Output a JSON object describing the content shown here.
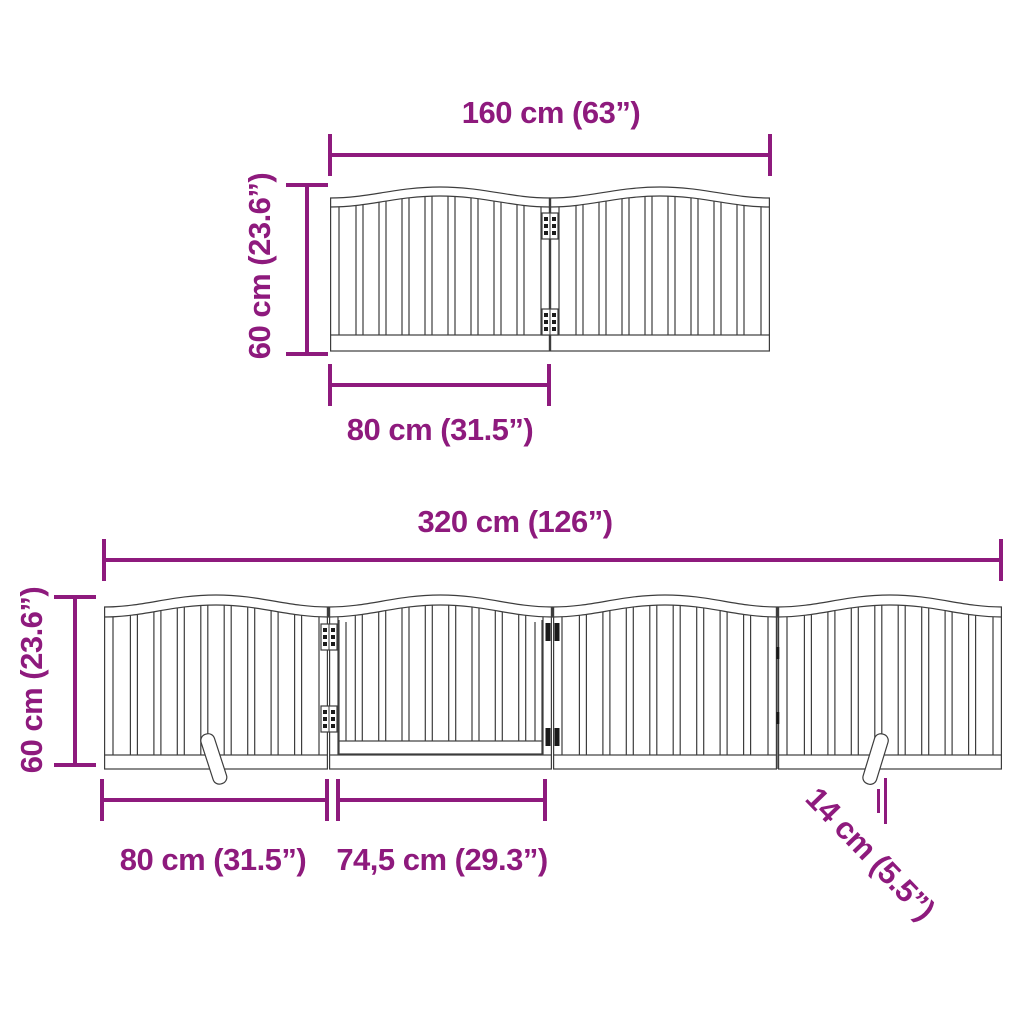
{
  "colors": {
    "dimension_accent": "#8E1A7D",
    "line_art": "#3D3D3D",
    "hardware_dark": "#1A1A1A",
    "background": "#FFFFFF"
  },
  "top_diagram": {
    "total_width_label": "160 cm (63”)",
    "height_label": "60 cm (23.6”)",
    "panel_width_label": "80 cm (31.5”)"
  },
  "bottom_diagram": {
    "total_width_label": "320 cm (126”)",
    "height_label": "60 cm (23.6”)",
    "panel_width_label": "80 cm (31.5”)",
    "door_width_label": "74,5 cm (29.3”)",
    "foot_length_label": "14 cm (5.5”)"
  }
}
